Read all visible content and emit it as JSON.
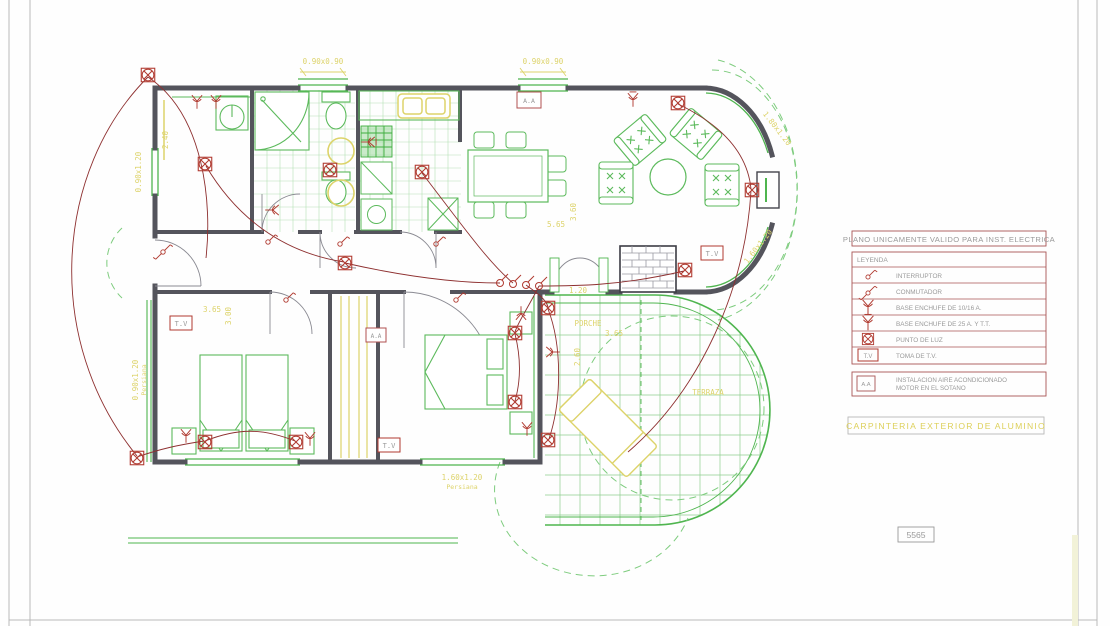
{
  "title_block": {
    "title": "PLANO UNICAMENTE VALIDO PARA INST. ELECTRICA"
  },
  "legend": {
    "header": "LEYENDA",
    "rows": [
      {
        "icon": "interruptor-symbol",
        "label": "INTERRUPTOR"
      },
      {
        "icon": "conmutador-symbol",
        "label": "CONMUTADOR"
      },
      {
        "icon": "enchufe-10-16-symbol",
        "label": "BASE ENCHUFE DE 10/16 A."
      },
      {
        "icon": "enchufe-25-tt-symbol",
        "label": "BASE ENCHUFE DE 25 A. Y T.T."
      },
      {
        "icon": "punto-de-luz-symbol",
        "label": "PUNTO DE LUZ"
      },
      {
        "icon": "toma-tv-symbol",
        "label": "TOMA DE T.V.",
        "symbol_text": "T.V"
      }
    ],
    "aa_row": {
      "symbol_text": "A.A",
      "label_line1": "INSTALACION AIRE ACONDICIONADO",
      "label_line2": "MOTOR EN EL SOTANO"
    }
  },
  "notes": {
    "carpinteria": "CARPINTERIA EXTERIOR DE ALUMINIO"
  },
  "sheet_number": "5565",
  "plan": {
    "rooms": {
      "porche": "PORCHE",
      "terraza": "TERRAZA"
    },
    "symbols": {
      "tv": "T.V",
      "aa": "A.A"
    },
    "dimensions": {
      "window_top_1": "0.90x0.90",
      "window_top_2": "0.90x0.90",
      "bay_upper": "1.80x1.20",
      "bay_lower": "1.60x1.20",
      "window_left_upper": "0.90x1.20",
      "window_left_lower": "0.90x1.20",
      "window_bottom": "1.60x1.20",
      "persiana": "Persiana",
      "d240": "2.40",
      "d365": "3.65",
      "d300": "3.00",
      "d565": "5.65",
      "d360": "3.60",
      "d120": "1.20",
      "d260": "2.60"
    }
  },
  "colors": {
    "wall": "#54545c",
    "green": "#4fb54f",
    "furniture_green": "#5cba5c",
    "tile_green": "#b4dfb4",
    "red_symbol": "#b03a30",
    "wire_red": "#8e3030",
    "yellow": "#ddd36a",
    "legend_border": "#a85454",
    "text_gray": "#9a9a9a"
  }
}
